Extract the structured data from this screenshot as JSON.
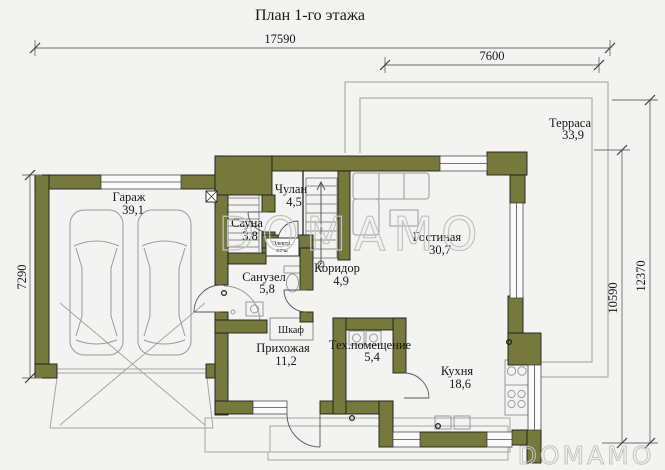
{
  "title": "План 1-го этажа",
  "dimensions": {
    "width_total": "17590",
    "width_terrace": "7600",
    "height_garage": "7290",
    "height_house": "10590",
    "height_total": "12370"
  },
  "rooms": {
    "garage": {
      "name": "Гараж",
      "area": "39,1"
    },
    "closet": {
      "name": "Чулан",
      "area": "4,5"
    },
    "sauna": {
      "name": "Сауна",
      "area": "3,8"
    },
    "bathroom": {
      "name": "Санузел",
      "area": "5,8"
    },
    "corridor": {
      "name": "Коридор",
      "area": "4,9"
    },
    "living": {
      "name": "Гостиная",
      "area": "30,7"
    },
    "hallway": {
      "name": "Прихожая",
      "area": "11,2"
    },
    "tech": {
      "name": "Тех.помещение",
      "area": "5,4"
    },
    "kitchen": {
      "name": "Кухня",
      "area": "18,6"
    },
    "terrace": {
      "name": "Терраса",
      "area": "33,9"
    }
  },
  "labels": {
    "wardrobe": "Шкаф",
    "stove_line1": "Электр.",
    "stove_line2": "печь"
  },
  "watermark": {
    "center": "DOMAMO",
    "corner": "DOMAMO"
  },
  "colors": {
    "wall": "#75793c",
    "bg": "#f3f3f1"
  }
}
